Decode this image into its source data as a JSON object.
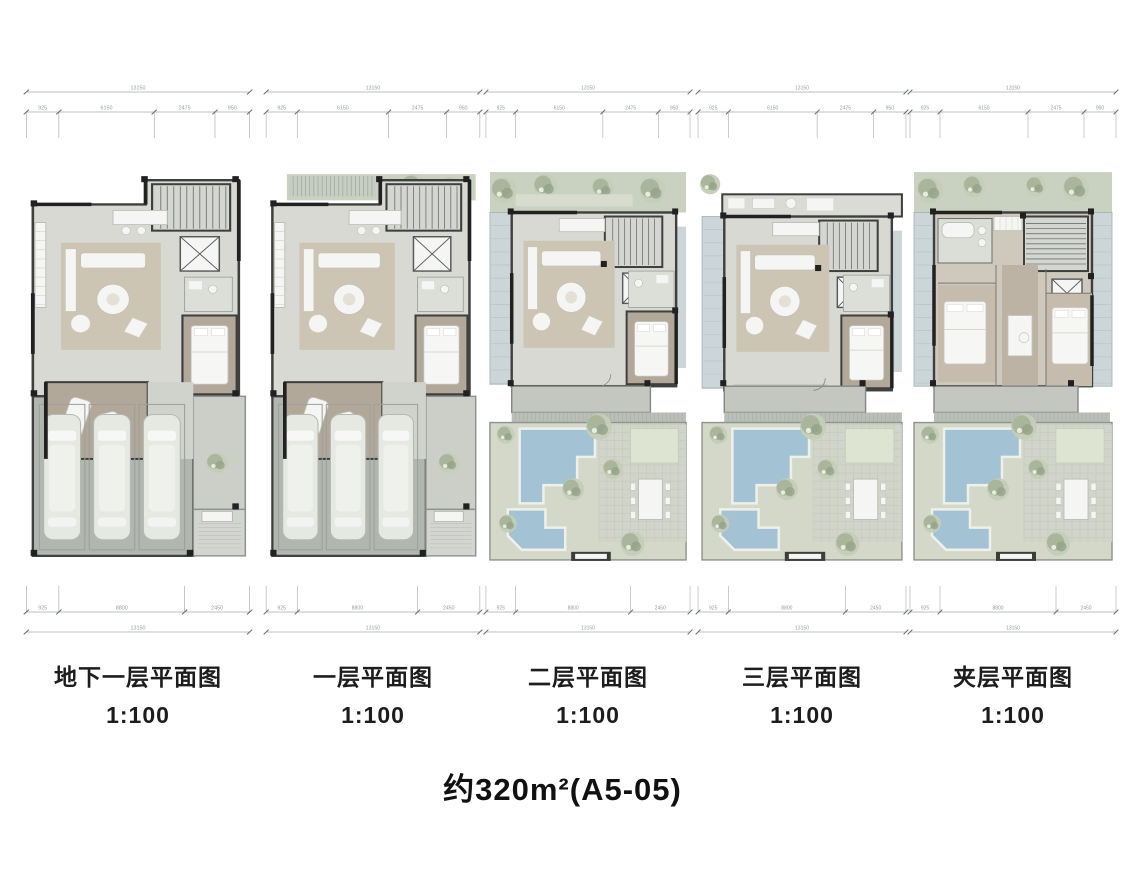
{
  "title": "约320m²(A5-05)",
  "panels": [
    {
      "name": "basement",
      "label": "地下一层平面图",
      "scale": "1:100",
      "kind": "house1"
    },
    {
      "name": "floor1",
      "label": "一层平面图",
      "scale": "1:100",
      "kind": "house2"
    },
    {
      "name": "floor2",
      "label": "二层平面图",
      "scale": "1:100",
      "kind": "garden1"
    },
    {
      "name": "floor3",
      "label": "三层平面图",
      "scale": "1:100",
      "kind": "garden2"
    },
    {
      "name": "mezzanine",
      "label": "夹层平面图",
      "scale": "1:100",
      "kind": "bedrooms"
    }
  ],
  "dimensions": {
    "top": {
      "total": "13150",
      "segments": [
        "925",
        "6150",
        "2475",
        "950"
      ]
    },
    "bottom": {
      "total": "13150",
      "segments": [
        "925",
        "8800",
        "2450"
      ]
    }
  },
  "colors": {
    "wall": "#3f403e",
    "wallDark": "#212121",
    "floor": "#d7d9d2",
    "floorLight": "#dcded8",
    "wood": "#b2a89a",
    "woodLight": "#c6bcae",
    "rug": "#ccc5b4",
    "white": "#f5f6f3",
    "garage": "#b2b6b0",
    "car": "#e5e9e2",
    "glass": "#ccd6d9",
    "gardenBand": "#c9d2c1",
    "garden": "#d3d8c8",
    "tree": "#a9b69c",
    "treeLight": "#c4ceb7",
    "treeDark": "#93a289",
    "pool": "#a3c2d4",
    "poolEdge": "#eef0ea",
    "terrace": "#c3c7c0",
    "tile": "#d0d4c9",
    "courtyard": "#cbcfc8",
    "dimLine": "#a7abab",
    "dimText": "#969c9c"
  }
}
